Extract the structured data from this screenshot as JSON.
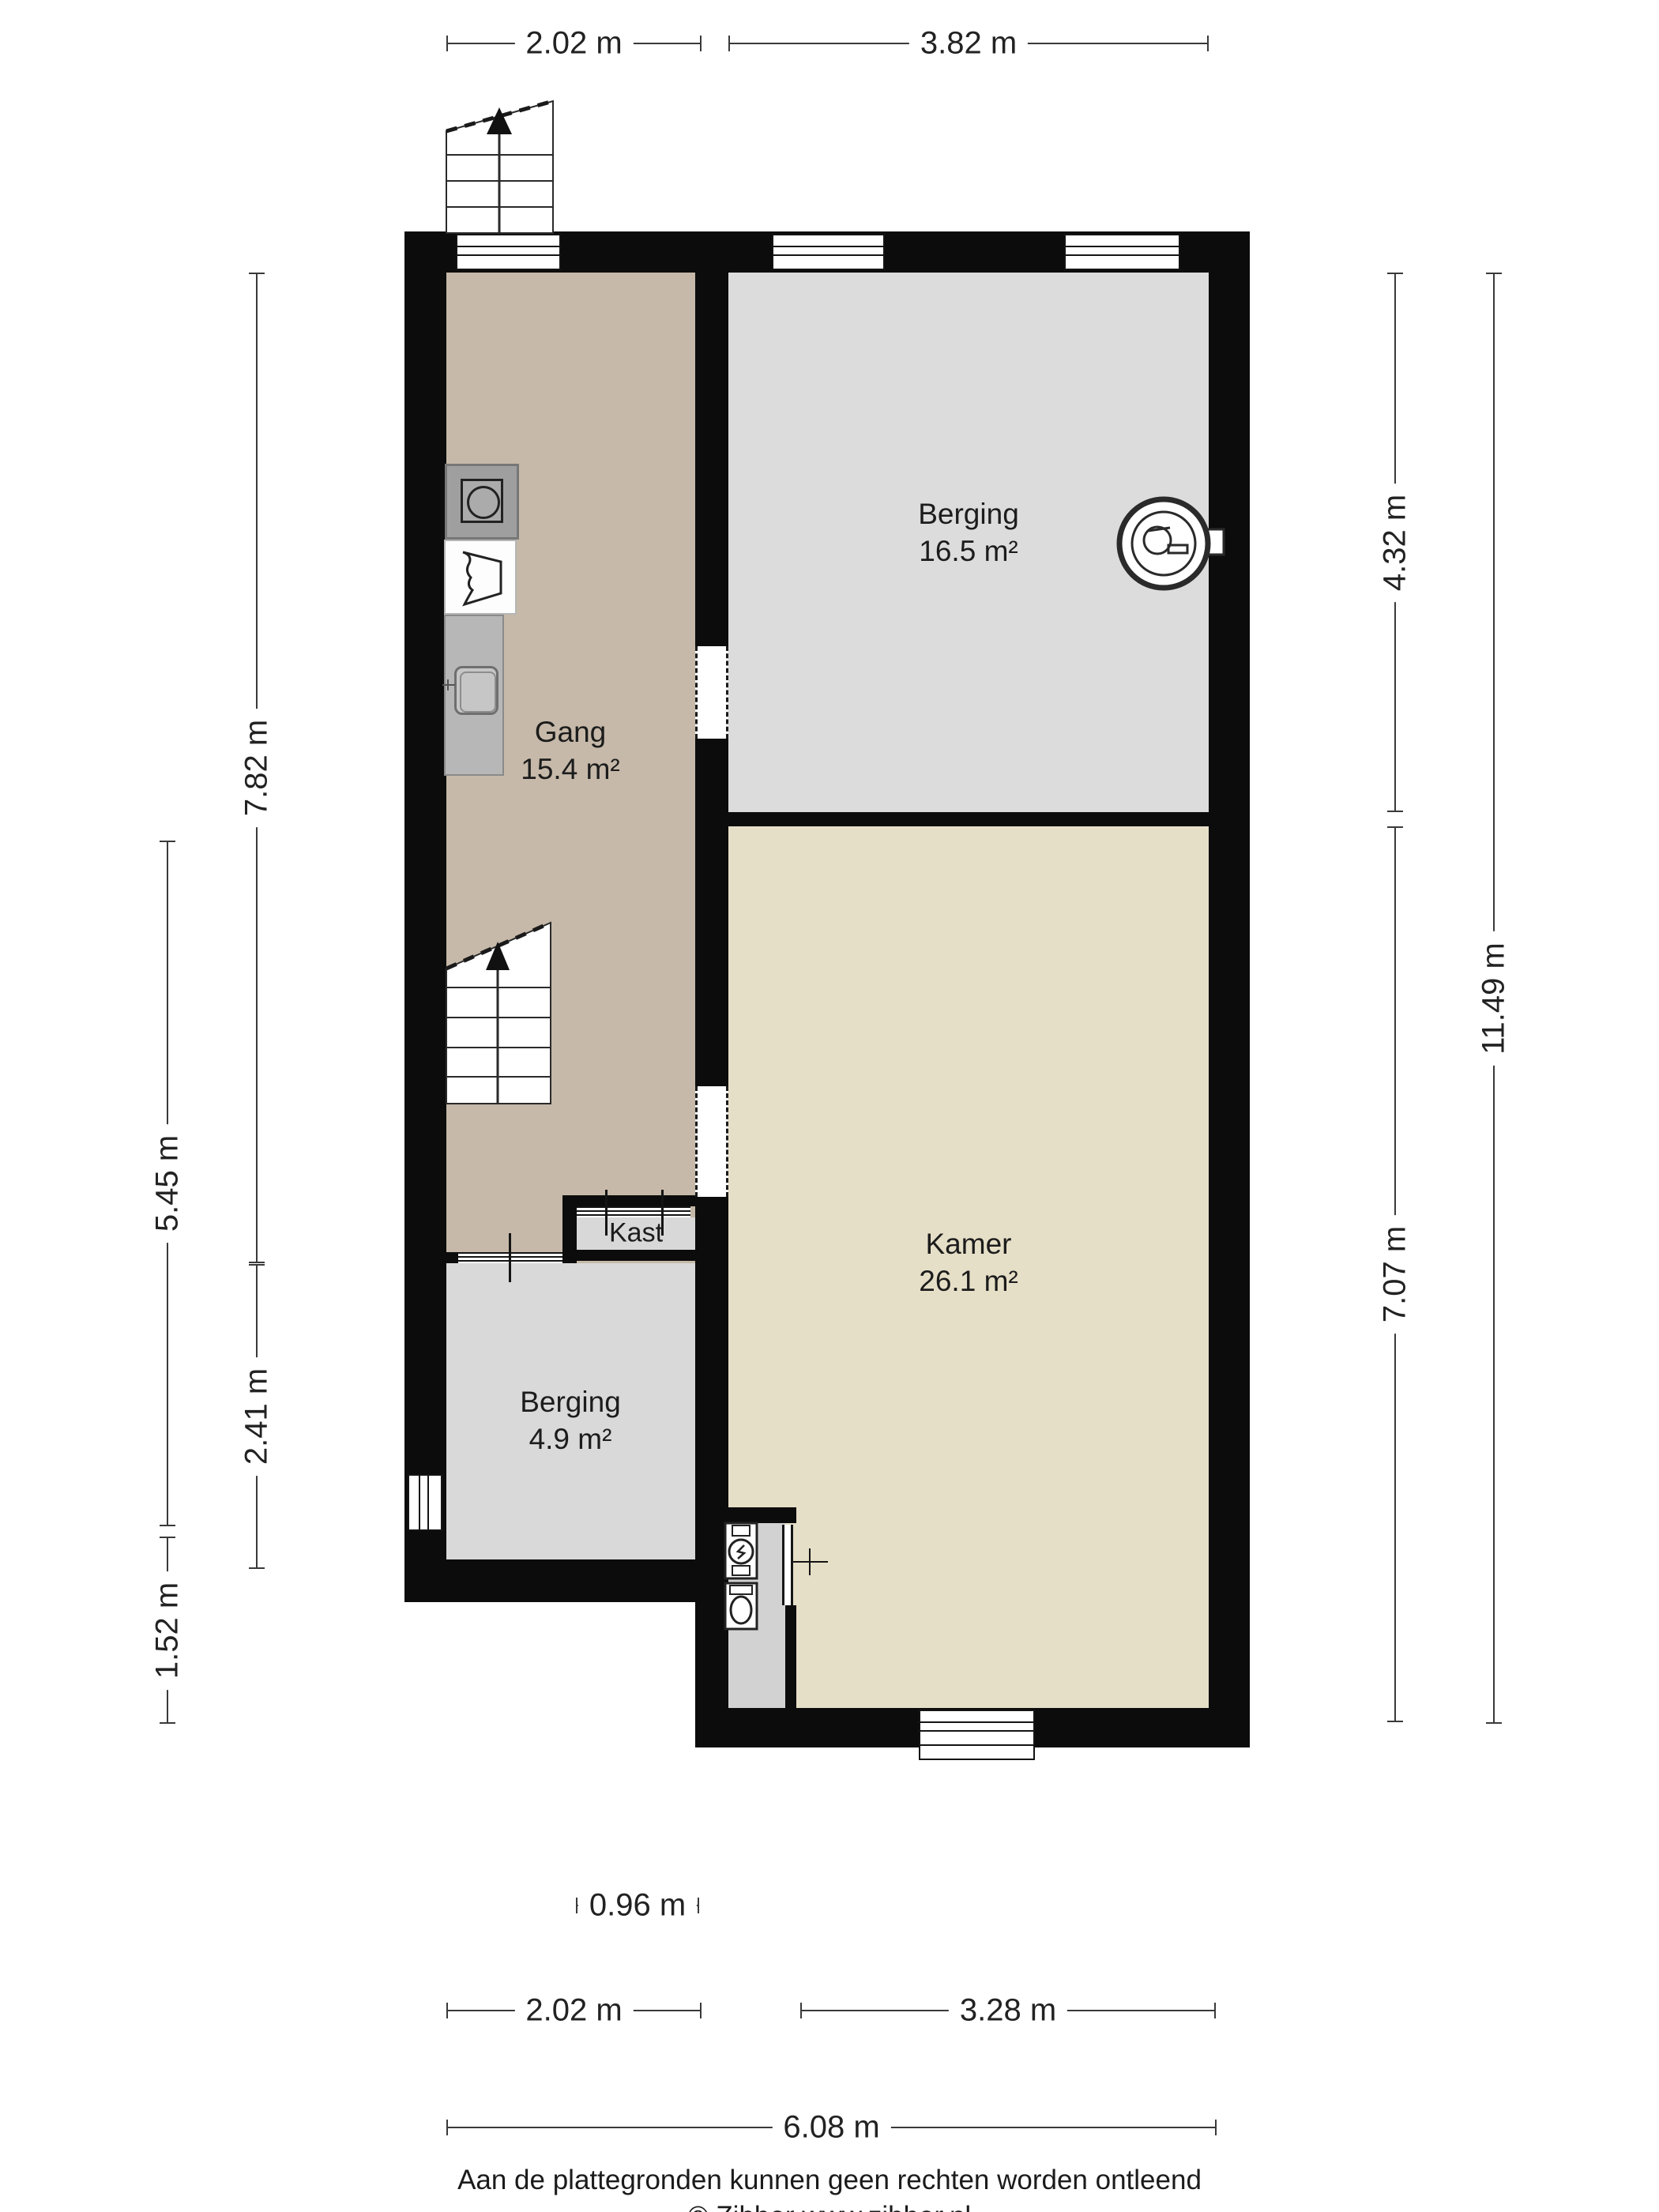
{
  "plan": {
    "title": "Floor plan (begane grond) – Zibber style",
    "rooms": {
      "gang": {
        "name": "Gang",
        "area": "15.4 m²"
      },
      "berging_top": {
        "name": "Berging",
        "area": "16.5 m²"
      },
      "kamer": {
        "name": "Kamer",
        "area": "26.1 m²"
      },
      "berging_bottom": {
        "name": "Berging",
        "area": "4.9 m²"
      },
      "kast": {
        "name": "Kast"
      }
    },
    "dimensions": {
      "top_gang": "2.02 m",
      "top_berging": "3.82 m",
      "left_545": "5.45 m",
      "left_152": "1.52 m",
      "left_782": "7.82 m",
      "left_241": "2.41 m",
      "right_432": "4.32 m",
      "right_707": "7.07 m",
      "right_1149": "11.49 m",
      "bottom_kast": "0.96 m",
      "bottom_berging": "2.02 m",
      "bottom_kamer": "3.28 m",
      "bottom_total": "6.08 m"
    },
    "footer": {
      "disclaimer": "Aan de plattegronden kunnen geen rechten worden ontleend",
      "copyright": "© Zibber www.zibber.nl"
    },
    "colors": {
      "wall": "#0c0c0c",
      "gang_floor": "#c6b9a9",
      "berging_floor": "#dcdcdc",
      "kamer_floor": "#e6dfc7",
      "kast_floor": "#d8d8d8",
      "alcove_floor": "#d2d2d2",
      "dimension": "#3a3a3a"
    },
    "icons": [
      "stairs-up",
      "washing-machine",
      "laundry-basket",
      "kitchen-sink",
      "boiler",
      "water-heater",
      "toilet",
      "window",
      "door-opening",
      "sliding-door"
    ]
  }
}
